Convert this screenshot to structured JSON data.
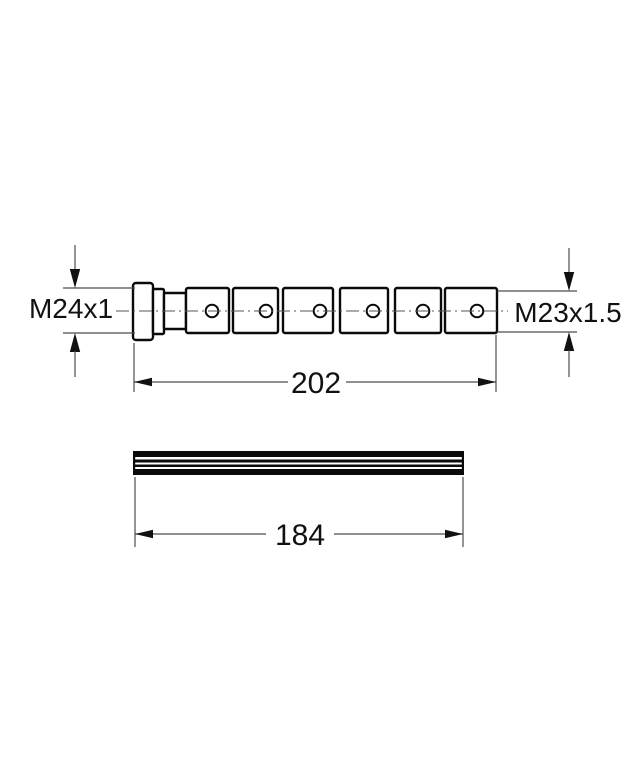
{
  "page": {
    "background_color": "#ffffff",
    "outline_color": "#0a0a0a",
    "thin_line_color": "#4d4d4d",
    "text_color": "#111111"
  },
  "drawing": {
    "side_view": {
      "left_thread_label": "M24x1",
      "right_thread_label": "M23x1.5",
      "length_label": "202",
      "segment_count": 6,
      "hole_count": 6
    },
    "profile_view": {
      "length_label": "184"
    }
  }
}
